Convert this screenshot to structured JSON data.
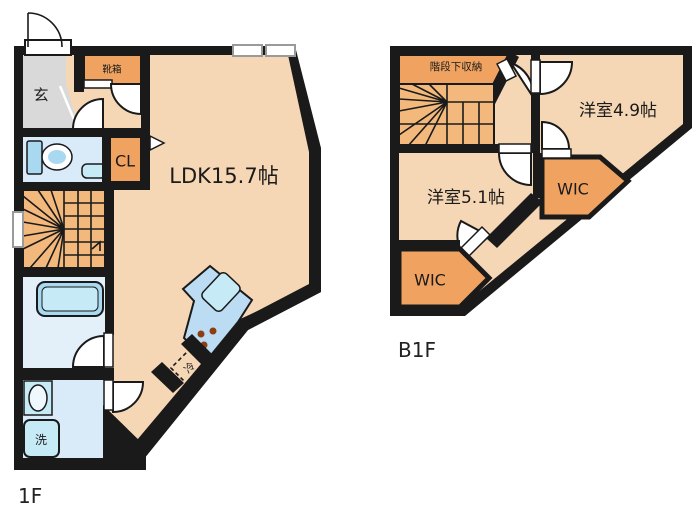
{
  "plan": {
    "f1": {
      "floor_label": "1F",
      "genkan": "玄",
      "shoe_box": "靴箱",
      "closet": "CL",
      "ldk": "LDK15.7帖",
      "washer": "洗",
      "fridge": "冷"
    },
    "b1": {
      "floor_label": "B1F",
      "under_stair_storage": "階段下収納",
      "bedroom_49": "洋室4.9帖",
      "wic_upper": "WIC",
      "bedroom_51": "洋室5.1帖",
      "wic_lower": "WIC"
    }
  },
  "colors": {
    "wall": "#1a1a1a",
    "floor_peach": "#f5d7b5",
    "orange": "#f0a361",
    "stair_orange": "#f3b97c",
    "genkan_gray": "#d9d9d9",
    "wet_floor": "#d9ebf8",
    "bath_floor": "#e3f0fa",
    "fixture_blue": "#a9d9f1",
    "fixture_light": "#c7eaf7",
    "counter_blue": "#bcdcf3",
    "burner_brown": "#8c3d12",
    "window_gray": "#9a9a9a",
    "background": "#ffffff"
  }
}
